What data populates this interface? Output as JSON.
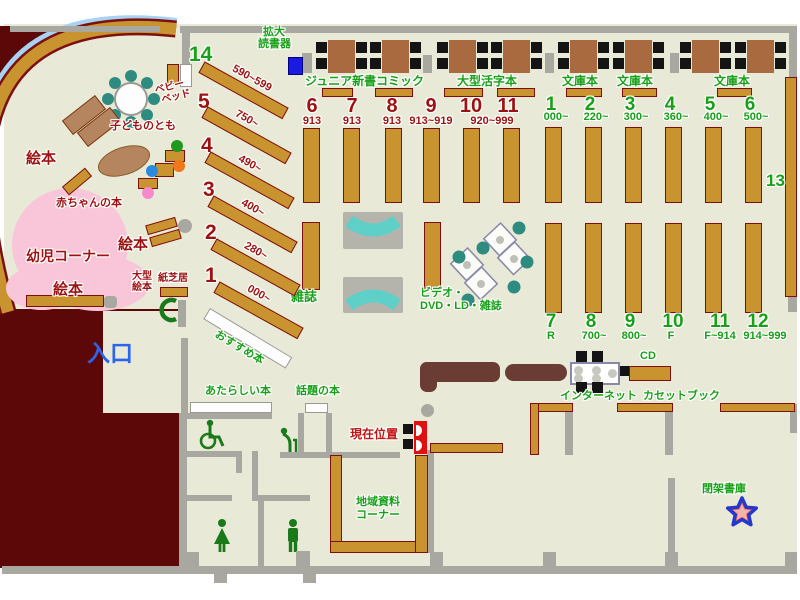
{
  "colors": {
    "floor": "#e9e9d8",
    "outside_wall_area": "#5c0808",
    "wood_shelf": "#c9942f",
    "shelf_border": "#7c1010",
    "table_brown": "#aa6a40",
    "wall_gray": "#a8a8a0",
    "green_text": "#18a018",
    "red_text": "#9c1212",
    "blue_text": "#2b65ec",
    "device_blue": "#1a1ae0",
    "rack_cyan": "#5fd0c8",
    "pink_area": "#f8c6d8",
    "curve_blue": "#a8d2f2",
    "counter_brown": "#6b3c34",
    "chair_teal": "#2e8b80"
  },
  "kids_area": {
    "picture_books": "絵本",
    "kodomo_no_tomo": "子どものとも",
    "baby_books": "赤ちゃんの本",
    "infant_corner": "幼児コーナー",
    "large_picture_l1": "大型",
    "large_picture_l2": "絵本",
    "kamishibai": "紙芝居",
    "baby_bed_l1": "ベビー",
    "baby_bed_l2": "ベッド"
  },
  "entrance": "入口",
  "device": {
    "l1": "拡大",
    "l2": "読書器"
  },
  "shelf_sections_top": {
    "junior": "ジュニア新書",
    "comic": "コミック",
    "large_print": "大型活字本",
    "bunko": "文庫本"
  },
  "diagonal_shelves": {
    "numbers": [
      "14",
      "5",
      "4",
      "3",
      "2",
      "1"
    ],
    "ranges": [
      "590~599",
      "750~",
      "490~",
      "400~",
      "280~",
      "000~"
    ]
  },
  "recommended": "おすすめ本",
  "section_900": {
    "numbers": [
      "6",
      "7",
      "8",
      "9",
      "10",
      "11"
    ],
    "ranges": [
      "913",
      "913",
      "913",
      "913~919",
      "920~999"
    ]
  },
  "section_top_right": {
    "numbers": [
      "1",
      "2",
      "3",
      "4",
      "5",
      "6"
    ],
    "ranges": [
      "000~",
      "220~",
      "300~",
      "360~",
      "400~",
      "500~"
    ]
  },
  "section_bottom_right": {
    "numbers": [
      "7",
      "8",
      "9",
      "10",
      "11",
      "12"
    ],
    "ranges": [
      "R",
      "700~",
      "800~",
      "F",
      "F~914",
      "914~999"
    ]
  },
  "area_13": "13",
  "magazines": "雑誌",
  "video": {
    "l1": "ビデオ・",
    "l2": "DVD・LD・雑誌"
  },
  "internet": "インターネット",
  "cd": "CD",
  "cassette_books": "カセットブック",
  "new_books": "あたらしい本",
  "topical_books": "話題の本",
  "local_materials": {
    "l1": "地域資料",
    "l2": "コーナー"
  },
  "closed_stacks": "閉架書庫",
  "current_position": "現在位置"
}
